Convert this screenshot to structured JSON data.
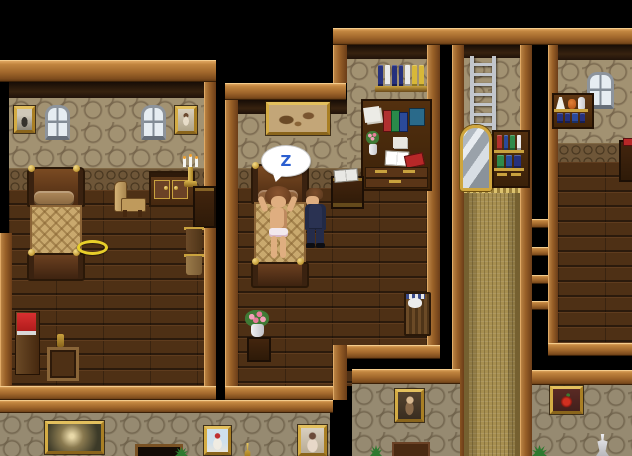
{
  "scene": {
    "speech_bubble_text": "Z"
  },
  "palette": {
    "background": "#000000",
    "wood_beam": "#a2682c",
    "wood_frame_dark": "#6b3d18",
    "wallpaper_tan": "#a29272",
    "wallpaper_ring": "#7c6a50",
    "wainscot_brown": "#6e5638",
    "floor_plank": "#4e3015",
    "carpet_gold": "#a78f50",
    "trim_gold": "#c9a23e",
    "mirror_silver": "#c9d0d6",
    "ladder_silver": "#c2c6cc",
    "suit_navy": "#2a3252",
    "skin": "#dfae80",
    "hair_brown": "#7a4828",
    "bubble_z_blue": "#2b5fd0",
    "blanket_tan": "#c9a96e",
    "red_cabinet": "#c42222",
    "ring_gold": "#e8cf2a"
  },
  "books": {
    "room2_wall_shelf": [
      "#26317d",
      "#e9e9e9",
      "#26317d",
      "#26317d",
      "#e9e9e9",
      "#d8b838",
      "#d8b838"
    ],
    "corridor_shelf_top": [
      "#b3312e",
      "#2a4a9a",
      "#2f8a4a",
      "#e8e8e8"
    ],
    "corridor_shelf_bottom": [
      "#2f8a4a",
      "#2a4a9a",
      "#26317d"
    ],
    "room4_shelf": [
      "#26317d",
      "#26317d",
      "#2a4a9a",
      "#26317d"
    ]
  }
}
